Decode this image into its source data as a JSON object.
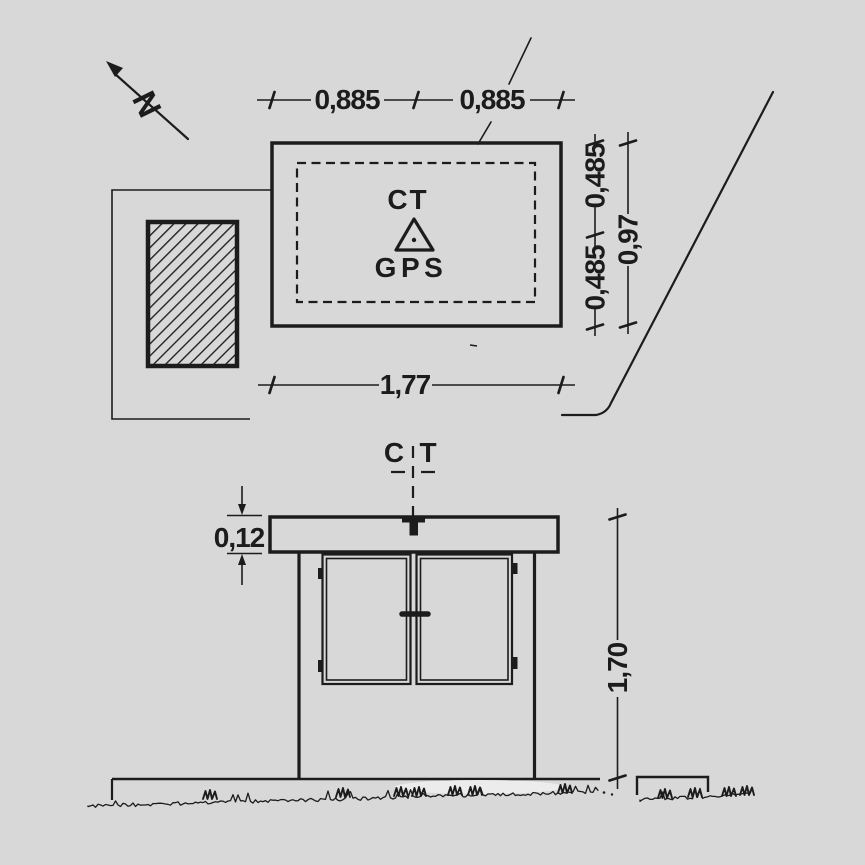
{
  "colors": {
    "paper": "#d8d8d8",
    "ink": "#1c1c1c"
  },
  "plan": {
    "north_label": "N",
    "dim_top": [
      "0,885",
      "0,885"
    ],
    "dim_bottom": "1,77",
    "dim_right_half_upper": "0,485",
    "dim_right_half_lower": "0,485",
    "dim_right_total": "0,97",
    "marker_label_top": "CT",
    "marker_label_bottom": "GPS"
  },
  "elevation": {
    "centerline_label_left": "C",
    "centerline_label_right": "T",
    "dim_roof_thickness": "0,12",
    "dim_height": "1,70"
  }
}
